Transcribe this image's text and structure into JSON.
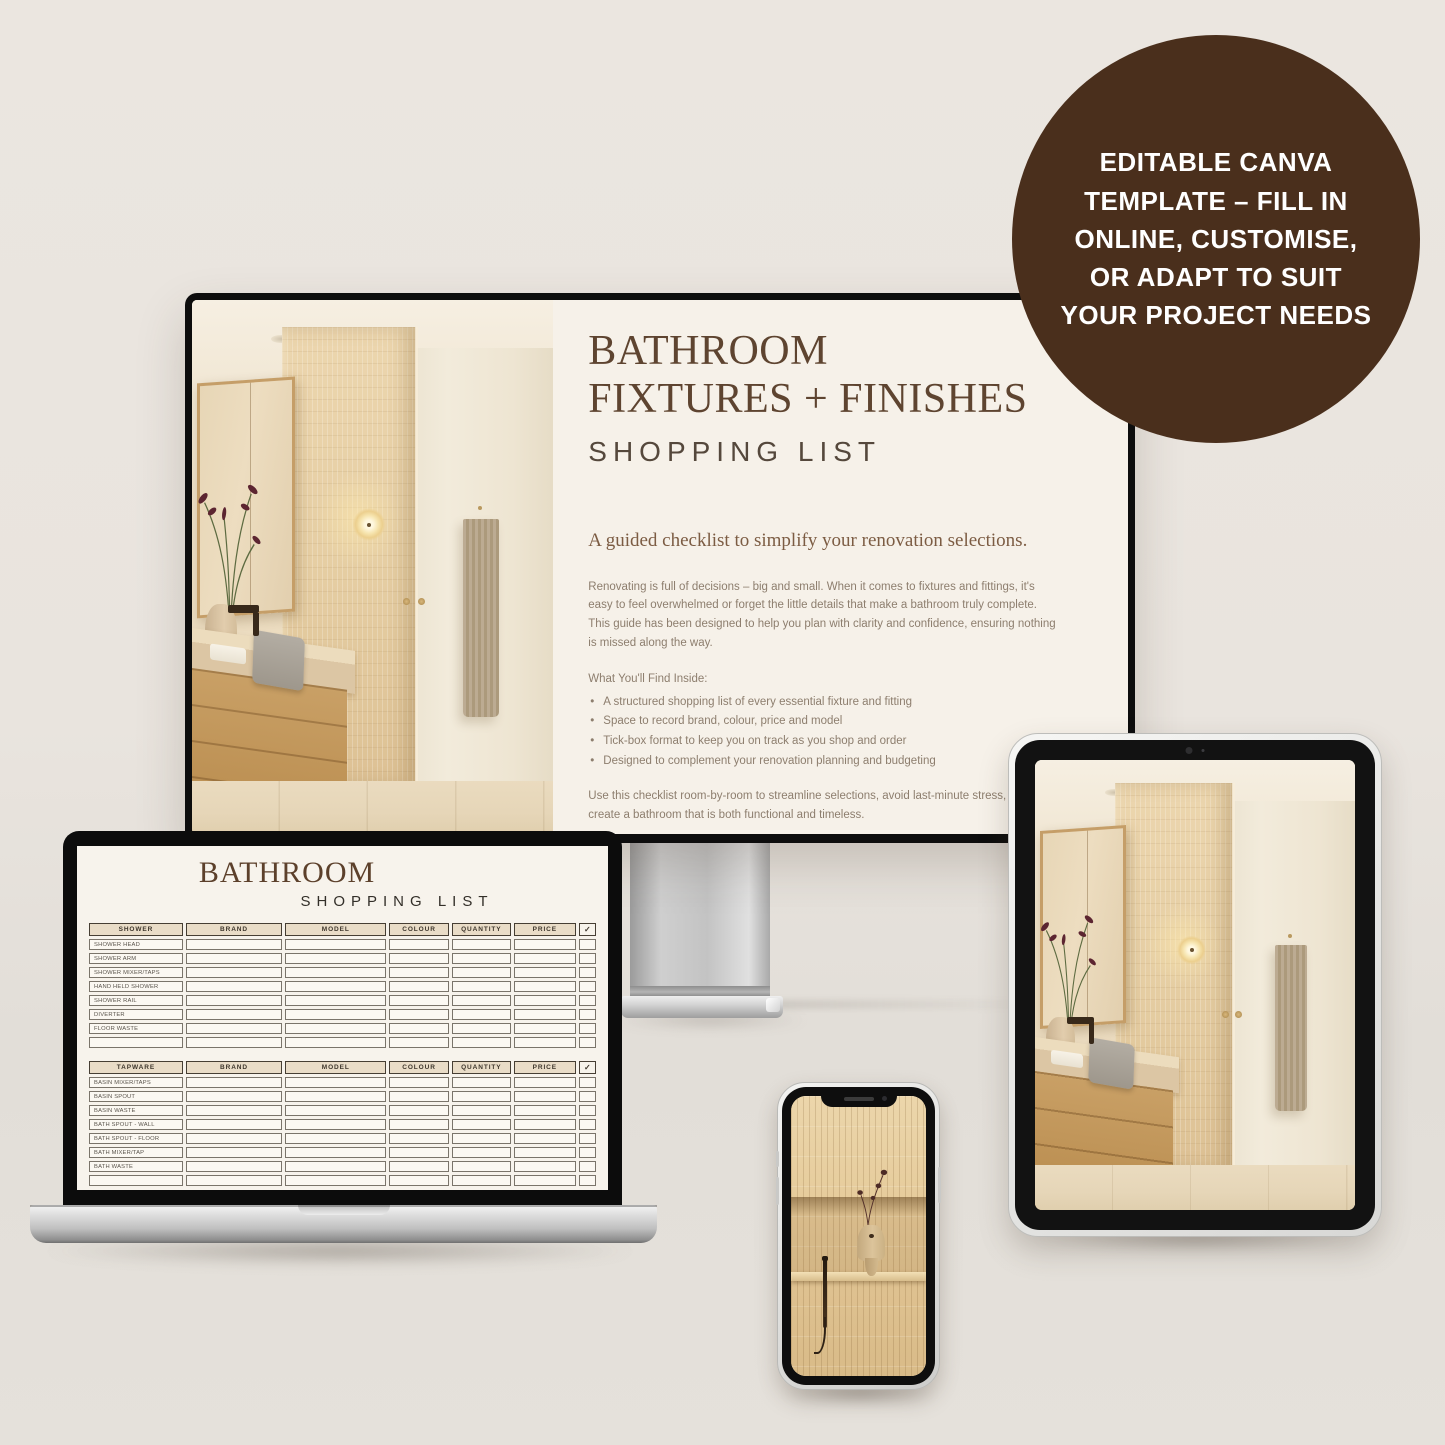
{
  "badge": {
    "text": "EDITABLE CANVA\nTEMPLATE – FILL IN\nONLINE, CUSTOMISE,\nOR ADAPT TO SUIT\nYOUR PROJECT NEEDS",
    "bg_color": "#4a2f1c",
    "text_color": "#ffffff"
  },
  "monitor_page": {
    "title": "BATHROOM\nFIXTURES + FINISHES",
    "subtitle": "SHOPPING LIST",
    "tagline": "A guided checklist to simplify your renovation selections.",
    "intro": "Renovating is full of decisions – big and small. When it comes to fixtures and fittings, it's easy to feel overwhelmed or forget the little details that make a bathroom truly complete. This guide has been designed to help you plan with clarity and confidence, ensuring nothing is missed along the way.",
    "find_inside": "What You'll Find Inside:",
    "bullets": [
      "A structured shopping list of every essential fixture and fitting",
      "Space to record brand, colour, price and model",
      "Tick-box format to keep you on track as you shop and order",
      "Designed to complement your renovation planning and budgeting"
    ],
    "outro": "Use this checklist room-by-room to streamline selections, avoid last-minute stress, and create a bathroom that is both functional and timeless."
  },
  "laptop_page": {
    "title": "BATHROOM",
    "subtitle": "SHOPPING LIST",
    "tables": [
      {
        "headers": [
          "SHOWER",
          "BRAND",
          "MODEL",
          "COLOUR",
          "QUANTITY",
          "PRICE",
          "✓"
        ],
        "rows": [
          "SHOWER HEAD",
          "SHOWER ARM",
          "SHOWER MIXER/TAPS",
          "HAND HELD SHOWER",
          "SHOWER RAIL",
          "DIVERTER",
          "FLOOR WASTE",
          ""
        ]
      },
      {
        "headers": [
          "TAPWARE",
          "BRAND",
          "MODEL",
          "COLOUR",
          "QUANTITY",
          "PRICE",
          "✓"
        ],
        "rows": [
          "BASIN MIXER/TAPS",
          "BASIN SPOUT",
          "BASIN WASTE",
          "BATH SPOUT - WALL",
          "BATH SPOUT - FLOOR",
          "BATH MIXER/TAP",
          "BATH WASTE",
          ""
        ]
      }
    ]
  },
  "colors": {
    "badge_brown": "#4a2f1c",
    "heading_brown": "#5e4430",
    "page_cream": "#f6f1e9",
    "table_header_fill": "#e9dcc7",
    "background": "#e8e3dd"
  }
}
